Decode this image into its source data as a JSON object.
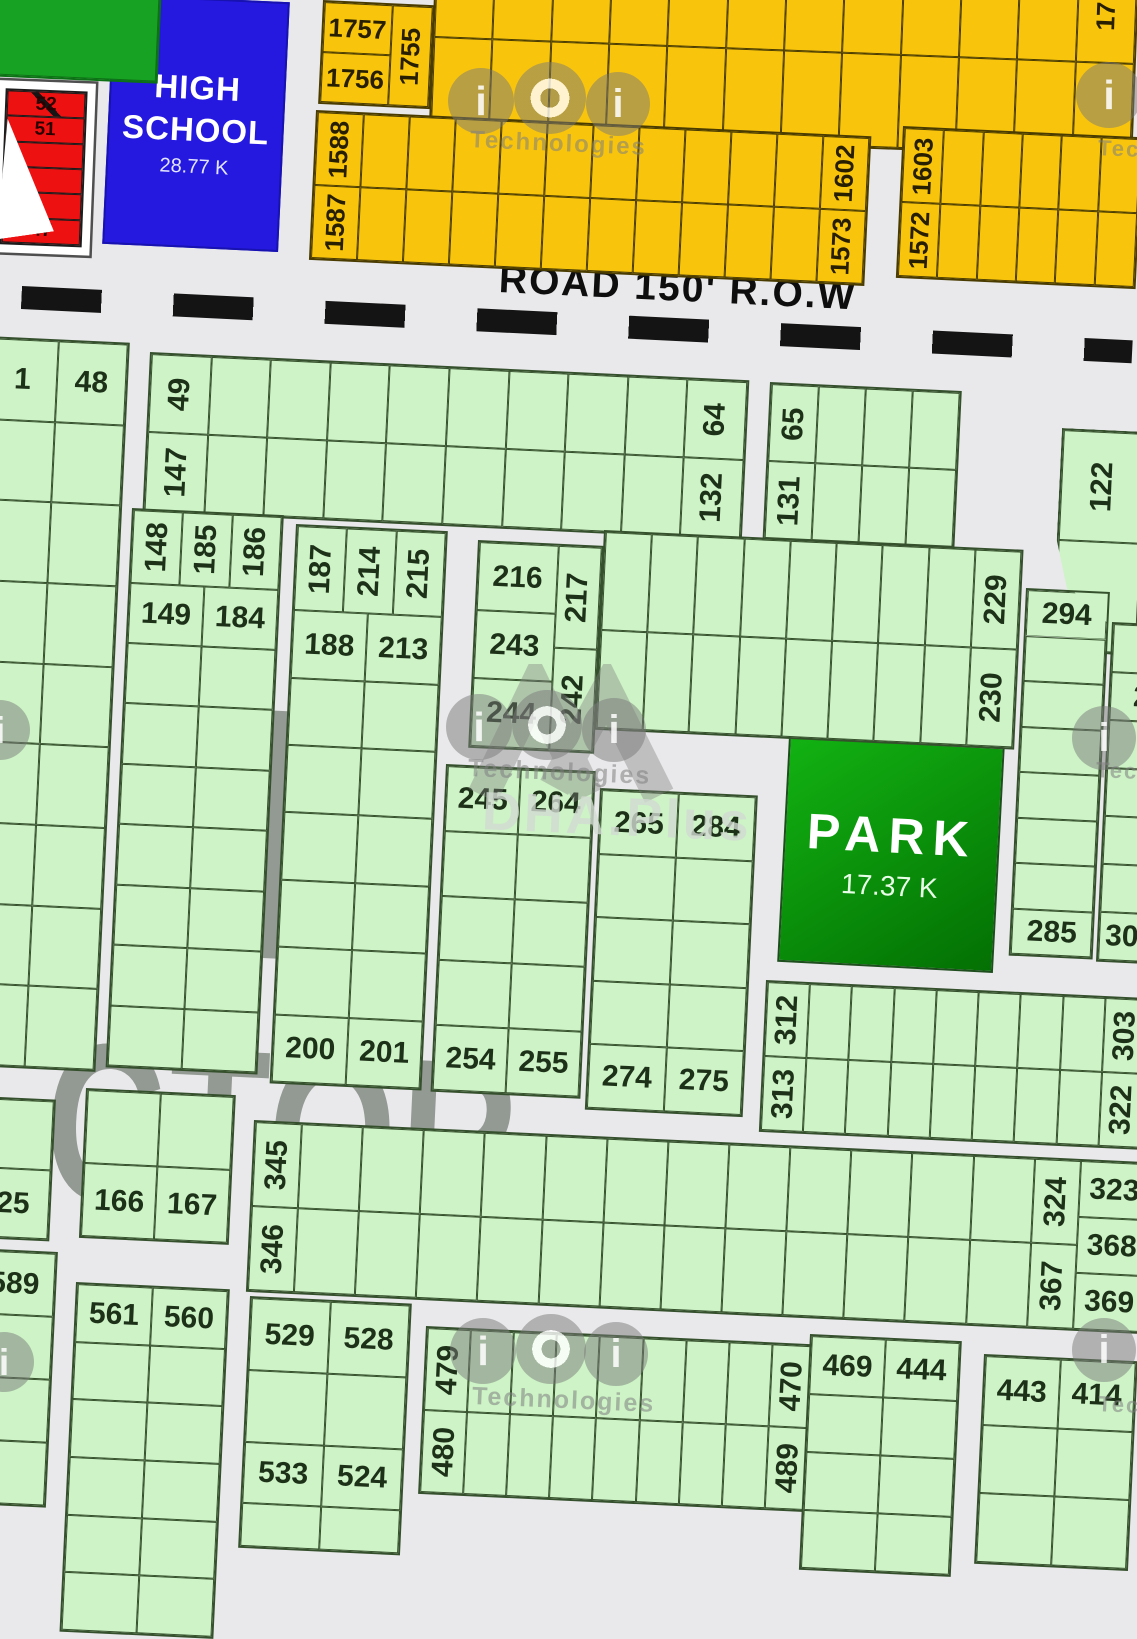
{
  "map": {
    "colors": {
      "street": "#e9e9eb",
      "plot_green": "#cdf3c6",
      "plot_orange": "#f9c50c",
      "plot_red": "#ee1111",
      "facility_green": "#18a224",
      "school_blue": "#2519e0",
      "park_green_from": "#12b212",
      "park_green_to": "#037003",
      "dash": "#141414"
    },
    "road": {
      "label": "ROAD 150' R.O.W"
    },
    "school": {
      "line1": "HIGH",
      "line2": "SCHOOL",
      "area": "28.77 K"
    },
    "park": {
      "title": "PARK",
      "area": "17.37 K"
    },
    "sector": {
      "letter": "H",
      "word": "ECTOR"
    },
    "watermark": {
      "glyph": "i",
      "tech": "Technologies",
      "tec_partial": "Tec",
      "dha": "DHA.Plus"
    },
    "blocks": [
      {
        "name": "facility-corner-block",
        "pal": "darkgreen",
        "x": -16,
        "y": -20,
        "w": 178,
        "h": 96,
        "rot": 2.5,
        "cols": [
          {
            "cells": [
              {}
            ]
          }
        ]
      },
      {
        "name": "orange-block-1757",
        "pal": "orange",
        "x": 323,
        "y": 0,
        "w": 112,
        "h": 104,
        "rot": 2.7,
        "cols": [
          {
            "cells": [
              {
                "t": "1757"
              },
              {
                "t": "1756"
              }
            ]
          },
          {
            "w": 0.6,
            "cells": [
              {
                "t": "1755",
                "v": 1
              }
            ]
          }
        ]
      },
      {
        "name": "orange-band-top",
        "pal": "orange",
        "x": 436,
        "y": -58,
        "w": 704,
        "h": 190,
        "rot": 2.2,
        "rows": [
          {
            "cells": [
              {
                "n": 11
              },
              {
                "t": "17",
                "v": 1
              }
            ]
          },
          {
            "cells": [
              {
                "n": 12
              }
            ]
          }
        ]
      },
      {
        "name": "orange-band-1588",
        "pal": "orange",
        "x": 316,
        "y": 110,
        "w": 556,
        "h": 150,
        "rot": 2.7,
        "rows": [
          {
            "cells": [
              {
                "t": "1588",
                "v": 1
              },
              {
                "n": 10
              },
              {
                "t": "1602",
                "v": 1
              }
            ]
          },
          {
            "cells": [
              {
                "t": "1587",
                "v": 1
              },
              {
                "n": 10
              },
              {
                "t": "1573",
                "v": 1
              }
            ]
          }
        ]
      },
      {
        "name": "orange-band-1603",
        "pal": "orange",
        "x": 903,
        "y": 126,
        "w": 240,
        "h": 152,
        "rot": 2.7,
        "rows": [
          {
            "cells": [
              {
                "t": "1603",
                "v": 1
              },
              {
                "n": 5
              }
            ]
          },
          {
            "cells": [
              {
                "t": "1572",
                "v": 1
              },
              {
                "n": 5
              }
            ]
          }
        ]
      },
      {
        "name": "red-strip-block",
        "pal": "red",
        "x": 6,
        "y": 88,
        "w": 82,
        "h": 156,
        "rot": 2.2,
        "frame": 8,
        "cols": [
          {
            "cells": [
              {
                "t": "52",
                "diag": 1
              },
              {
                "t": "51"
              },
              {},
              {},
              {},
              {
                "t": "47"
              }
            ]
          }
        ]
      },
      {
        "name": "green-block-1-48",
        "pal": "green",
        "x": -12,
        "y": 336,
        "w": 142,
        "h": 730,
        "rot": 2.7,
        "rows": [
          {
            "cells": [
              {
                "t": "1"
              },
              {
                "t": "48"
              }
            ]
          },
          {
            "rep": 8,
            "cells": [
              {},
              {}
            ]
          }
        ]
      },
      {
        "name": "green-band-49-147",
        "pal": "green",
        "x": 150,
        "y": 352,
        "w": 600,
        "h": 160,
        "rot": 2.7,
        "rows": [
          {
            "cells": [
              {
                "t": "49",
                "v": 1
              },
              {
                "n": 8
              },
              {
                "t": "64",
                "v": 1
              }
            ]
          },
          {
            "cells": [
              {
                "t": "147",
                "v": 1
              },
              {
                "n": 8
              },
              {
                "t": "132",
                "v": 1
              }
            ]
          }
        ]
      },
      {
        "name": "green-band-65-131",
        "pal": "green",
        "x": 770,
        "y": 382,
        "w": 192,
        "h": 158,
        "rot": 2.7,
        "rows": [
          {
            "cells": [
              {
                "t": "65",
                "v": 1
              },
              {
                "n": 3
              }
            ]
          },
          {
            "cells": [
              {
                "t": "131",
                "v": 1
              },
              {
                "n": 3
              }
            ]
          }
        ]
      },
      {
        "name": "green-block-122",
        "pal": "green",
        "x": 1062,
        "y": 428,
        "w": 86,
        "h": 224,
        "rot": 2.7,
        "clip": "polygon(0 0,100% 0,100% 100%,34% 100%,0 50%)",
        "cols": [
          {
            "cells": [
              {
                "t": "122",
                "v": 1
              },
              {}
            ]
          }
        ]
      },
      {
        "name": "green-block-148",
        "pal": "green",
        "x": 132,
        "y": 508,
        "w": 152,
        "h": 560,
        "rot": 2.7,
        "rows": [
          {
            "h": 1.2,
            "cells": [
              {
                "t": "148",
                "v": 1
              },
              {
                "t": "185",
                "v": 1
              },
              {
                "t": "186",
                "v": 1
              }
            ]
          },
          {
            "cells": [
              {
                "t": "149"
              },
              {
                "t": "184"
              }
            ]
          },
          {
            "rep": 7,
            "cells": [
              {},
              {}
            ]
          }
        ]
      },
      {
        "name": "green-block-187",
        "pal": "green",
        "x": 296,
        "y": 524,
        "w": 152,
        "h": 560,
        "rot": 2.7,
        "rows": [
          {
            "h": 1.25,
            "cells": [
              {
                "t": "187",
                "v": 1
              },
              {
                "t": "214",
                "v": 1
              },
              {
                "t": "215",
                "v": 1
              }
            ]
          },
          {
            "cells": [
              {
                "t": "188"
              },
              {
                "t": "213"
              }
            ]
          },
          {
            "rep": 5,
            "cells": [
              {},
              {}
            ]
          },
          {
            "cells": [
              {
                "t": "200"
              },
              {
                "t": "201"
              }
            ]
          }
        ]
      },
      {
        "name": "green-block-216",
        "pal": "green",
        "x": 478,
        "y": 540,
        "w": 126,
        "h": 208,
        "rot": 2.7,
        "cols": [
          {
            "cells": [
              {
                "t": "216"
              },
              {
                "t": "243"
              },
              {
                "t": "244"
              }
            ]
          },
          {
            "w": 0.55,
            "cells": [
              {
                "t": "217",
                "v": 1
              },
              {
                "t": "242",
                "v": 1
              }
            ]
          }
        ]
      },
      {
        "name": "green-band-229",
        "pal": "green",
        "x": 604,
        "y": 530,
        "w": 420,
        "h": 200,
        "rot": 2.7,
        "rows": [
          {
            "cells": [
              {
                "n": 8
              },
              {
                "t": "229",
                "v": 1
              }
            ]
          },
          {
            "cells": [
              {
                "n": 8
              },
              {
                "t": "230",
                "v": 1
              }
            ]
          }
        ]
      },
      {
        "name": "green-block-245",
        "pal": "green",
        "x": 446,
        "y": 764,
        "w": 150,
        "h": 328,
        "rot": 2.7,
        "rows": [
          {
            "cells": [
              {
                "t": "245"
              },
              {
                "t": "264"
              }
            ]
          },
          {
            "rep": 3,
            "cells": [
              {},
              {}
            ]
          },
          {
            "cells": [
              {
                "t": "254"
              },
              {
                "t": "255"
              }
            ]
          }
        ]
      },
      {
        "name": "green-block-265",
        "pal": "green",
        "x": 600,
        "y": 788,
        "w": 158,
        "h": 322,
        "rot": 2.7,
        "rows": [
          {
            "cells": [
              {
                "t": "265"
              },
              {
                "t": "284"
              }
            ]
          },
          {
            "rep": 3,
            "cells": [
              {},
              {}
            ]
          },
          {
            "cells": [
              {
                "t": "274"
              },
              {
                "t": "275"
              }
            ]
          }
        ]
      },
      {
        "name": "green-column-294",
        "pal": "green",
        "x": 1026,
        "y": 588,
        "w": 84,
        "h": 368,
        "rot": 2.7,
        "cols": [
          {
            "cells": [
              {
                "t": "294",
                "clip": "polygon(0 0,58% 0,100% 62%,100% 100%,0 100%)"
              },
              {
                "n": 6
              },
              {
                "t": "285"
              }
            ]
          }
        ]
      },
      {
        "name": "green-column-302",
        "pal": "green",
        "x": 1112,
        "y": 622,
        "w": 66,
        "h": 340,
        "rot": 2.7,
        "cols": [
          {
            "cells": [
              {},
              {
                "t": "2"
              },
              {
                "n": 4
              },
              {
                "t": "302"
              }
            ]
          }
        ]
      },
      {
        "name": "green-band-312",
        "pal": "green",
        "x": 766,
        "y": 980,
        "w": 384,
        "h": 152,
        "rot": 2.7,
        "rows": [
          {
            "cells": [
              {
                "t": "312",
                "v": 1
              },
              {
                "n": 7
              },
              {
                "t": "303",
                "v": 1
              }
            ]
          },
          {
            "cells": [
              {
                "t": "313",
                "v": 1
              },
              {
                "n": 7
              },
              {
                "t": "322",
                "v": 1
              }
            ]
          }
        ]
      },
      {
        "name": "green-band-345",
        "pal": "green",
        "x": 254,
        "y": 1120,
        "w": 900,
        "h": 172,
        "rot": 2.7,
        "cols": [
          {
            "w": 0.75,
            "cells": [
              {
                "t": "345",
                "v": 1
              },
              {
                "t": "346",
                "v": 1
              }
            ]
          },
          {
            "rep": 12,
            "cells": [
              {},
              {}
            ]
          },
          {
            "w": 0.75,
            "cells": [
              {
                "t": "324",
                "v": 1
              },
              {
                "t": "367",
                "v": 1
              }
            ]
          },
          {
            "w": 1.15,
            "cells": [
              {
                "t": "323"
              },
              {
                "t": "368"
              },
              {
                "t": "369"
              }
            ]
          }
        ]
      },
      {
        "name": "green-block-25",
        "pal": "green",
        "x": -20,
        "y": 1096,
        "w": 76,
        "h": 142,
        "rot": 2.7,
        "cols": [
          {
            "cells": [
              {},
              {
                "t": "25"
              }
            ]
          }
        ]
      },
      {
        "name": "green-block-166",
        "pal": "green",
        "x": 86,
        "y": 1088,
        "w": 150,
        "h": 150,
        "rot": 2.7,
        "rows": [
          {
            "cells": [
              {},
              {}
            ]
          },
          {
            "cells": [
              {
                "t": "166"
              },
              {
                "t": "167"
              }
            ]
          }
        ]
      },
      {
        "name": "green-block-589",
        "pal": "green",
        "x": -26,
        "y": 1248,
        "w": 84,
        "h": 256,
        "rot": 2.7,
        "cols": [
          {
            "cells": [
              {
                "t": "589"
              },
              {
                "n": 3
              }
            ]
          }
        ]
      },
      {
        "name": "green-block-561",
        "pal": "green",
        "x": 76,
        "y": 1282,
        "w": 154,
        "h": 350,
        "rot": 2.7,
        "rows": [
          {
            "cells": [
              {
                "t": "561"
              },
              {
                "t": "560"
              }
            ]
          },
          {
            "rep": 5,
            "cells": [
              {},
              {}
            ]
          }
        ]
      },
      {
        "name": "green-block-529",
        "pal": "green",
        "x": 250,
        "y": 1296,
        "w": 162,
        "h": 252,
        "rot": 2.7,
        "rows": [
          {
            "cells": [
              {
                "t": "529"
              },
              {
                "t": "528"
              }
            ]
          },
          {
            "cells": [
              {},
              {}
            ]
          },
          {
            "h": 0.85,
            "cells": [
              {
                "t": "533"
              },
              {
                "t": "524"
              }
            ]
          },
          {
            "h": 0.6,
            "cells": [
              {},
              {}
            ]
          }
        ]
      },
      {
        "name": "green-band-479",
        "pal": "green",
        "x": 426,
        "y": 1326,
        "w": 392,
        "h": 168,
        "rot": 2.7,
        "rows": [
          {
            "cells": [
              {
                "t": "479",
                "v": 1
              },
              {
                "n": 7
              },
              {
                "t": "470",
                "v": 1
              }
            ]
          },
          {
            "cells": [
              {
                "t": "480",
                "v": 1
              },
              {
                "n": 7
              },
              {
                "t": "489",
                "v": 1
              }
            ]
          }
        ]
      },
      {
        "name": "green-block-469",
        "pal": "green",
        "x": 810,
        "y": 1334,
        "w": 152,
        "h": 236,
        "rot": 2.7,
        "rows": [
          {
            "cells": [
              {
                "t": "469"
              },
              {
                "t": "444"
              }
            ]
          },
          {
            "rep": 3,
            "cells": [
              {},
              {}
            ]
          }
        ]
      },
      {
        "name": "green-block-443",
        "pal": "green",
        "x": 984,
        "y": 1354,
        "w": 154,
        "h": 210,
        "rot": 2.7,
        "rows": [
          {
            "cells": [
              {
                "t": "443"
              },
              {
                "t": "414"
              }
            ]
          },
          {
            "rep": 2,
            "cells": [
              {},
              {}
            ]
          }
        ]
      }
    ],
    "watermarks": [
      {
        "kind": "i",
        "x": 448,
        "y": 68,
        "d": 66
      },
      {
        "kind": "ring",
        "x": 514,
        "y": 62,
        "d": 72
      },
      {
        "kind": "i",
        "x": 586,
        "y": 72,
        "d": 64
      },
      {
        "kind": "text",
        "x": 470,
        "y": 130,
        "size": 24
      },
      {
        "kind": "i",
        "x": 1076,
        "y": 62,
        "d": 66
      },
      {
        "kind": "tec",
        "x": 1098,
        "y": 136,
        "size": 22
      },
      {
        "kind": "chev",
        "x": 466,
        "y": 664,
        "w": 210,
        "h": 150
      },
      {
        "kind": "i",
        "x": 446,
        "y": 694,
        "d": 66
      },
      {
        "kind": "ring",
        "x": 512,
        "y": 690,
        "d": 70
      },
      {
        "kind": "i",
        "x": 582,
        "y": 698,
        "d": 64
      },
      {
        "kind": "text",
        "x": 468,
        "y": 758,
        "size": 25
      },
      {
        "kind": "dha",
        "x": 482,
        "y": 786,
        "size": 54
      },
      {
        "kind": "i",
        "x": 1072,
        "y": 706,
        "d": 64
      },
      {
        "kind": "tec",
        "x": 1096,
        "y": 758,
        "size": 22
      },
      {
        "kind": "i",
        "x": -30,
        "y": 700,
        "d": 60
      },
      {
        "kind": "i",
        "x": 450,
        "y": 1318,
        "d": 66
      },
      {
        "kind": "ring",
        "x": 516,
        "y": 1314,
        "d": 70
      },
      {
        "kind": "i",
        "x": 584,
        "y": 1322,
        "d": 64
      },
      {
        "kind": "text",
        "x": 472,
        "y": 1386,
        "size": 25
      },
      {
        "kind": "i",
        "x": 1072,
        "y": 1318,
        "d": 64
      },
      {
        "kind": "tec",
        "x": 1098,
        "y": 1392,
        "size": 22
      },
      {
        "kind": "i",
        "x": -26,
        "y": 1332,
        "d": 60
      }
    ]
  }
}
